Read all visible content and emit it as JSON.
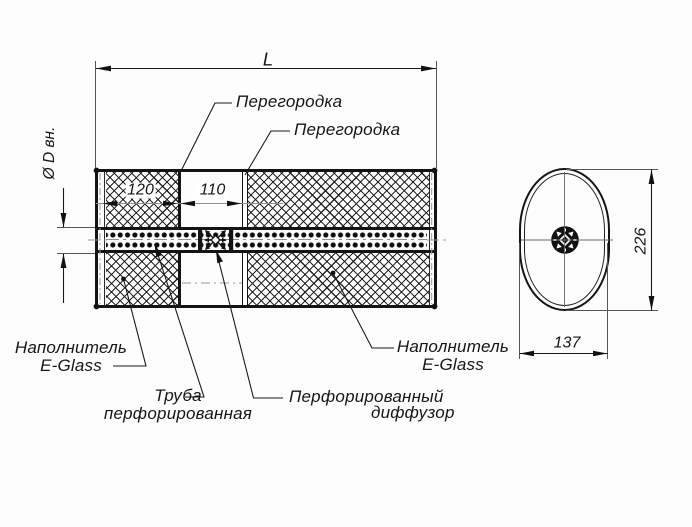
{
  "colors": {
    "ink": "#161616",
    "dim_gray": "#8f8f8f",
    "bg": "#fdfdfd"
  },
  "side_view": {
    "overall_length_label": "L",
    "inner_diameter_label": "Ø D вн.",
    "chamber1_length": "120",
    "chamber2_length": "110",
    "callouts": {
      "partition_1": "Перегородка",
      "partition_2": "Перегородка",
      "filler_left_line1": "Наполнитель",
      "filler_left_line2": "E-Glass",
      "filler_right_line1": "Наполнитель",
      "filler_right_line2": "E-Glass",
      "perforated_pipe_line1": "Труба",
      "perforated_pipe_line2": "перфорированная",
      "perforated_diffuser_line1": "Перфорированный",
      "perforated_diffuser_line2": "диффузор"
    }
  },
  "end_view": {
    "height_dim": "226",
    "width_dim": "137"
  }
}
